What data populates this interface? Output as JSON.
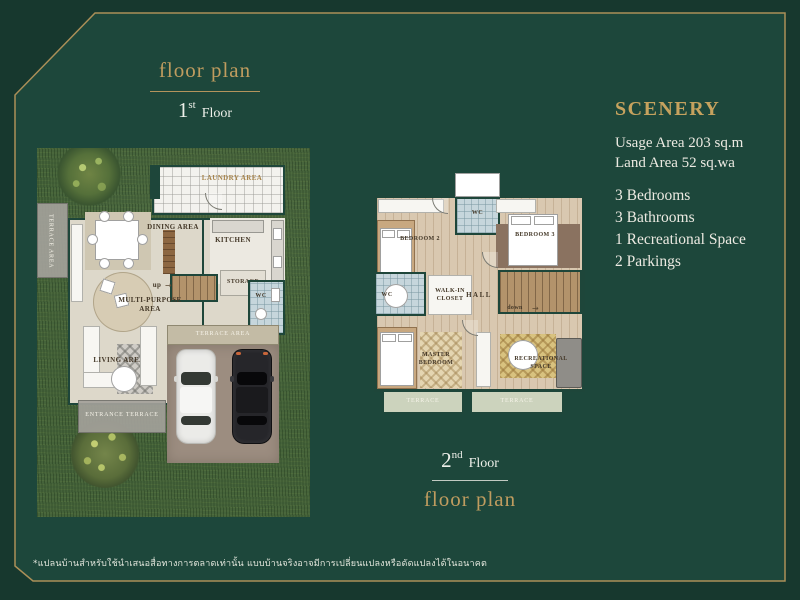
{
  "colors": {
    "background_outer": "#17382e",
    "background_inner": "#1d473b",
    "gold_accent": "#b3945c",
    "text_white": "#eceae2"
  },
  "header_first": {
    "title": "floor plan",
    "number": "1",
    "suffix": "st",
    "word": "Floor"
  },
  "footer_second": {
    "number": "2",
    "suffix": "nd",
    "word": "Floor",
    "title": "floor plan"
  },
  "info": {
    "title": "SCENERY",
    "usage_area": "Usage Area 203 sq.m",
    "land_area": "Land Area 52 sq.wa",
    "features": [
      "3 Bedrooms",
      "3 Bathrooms",
      "1 Recreational Space",
      "2 Parkings"
    ]
  },
  "floor1": {
    "laundry": "LAUNDRY AREA",
    "terrace_left": "TERRACE AREA",
    "dining": "DINING AREA",
    "kitchen": "KITCHEN",
    "up": "up",
    "storage": "STORAGE",
    "wc": "WC",
    "multi_purpose": "MULTI-PURPOSE\nAREA",
    "terrace_front": "TERRACE AREA",
    "living": "LIVING AREA",
    "entrance": "ENTRANCE TERRACE"
  },
  "floor2": {
    "wc_top": "WC",
    "bedroom2": "BEDROOM 2",
    "bedroom3": "BEDROOM 3",
    "wc_left": "WC",
    "closet": "WALK-IN\nCLOSET",
    "hall": "HALL",
    "down": "down",
    "master": "MASTER\nBEDROOM",
    "recreation": "RECREATIONAL\nSPACE",
    "terrace_a": "TERRACE",
    "terrace_b": "TERRACE"
  },
  "icons": {
    "up_arrow": "→",
    "down_arrow": "→"
  },
  "disclaimer": "*แปลนบ้านสำหรับใช้นำเสนอสื่อทางการตลาดเท่านั้น แบบบ้านจริงอาจมีการเปลี่ยนแปลงหรือดัดแปลงได้ในอนาคต"
}
